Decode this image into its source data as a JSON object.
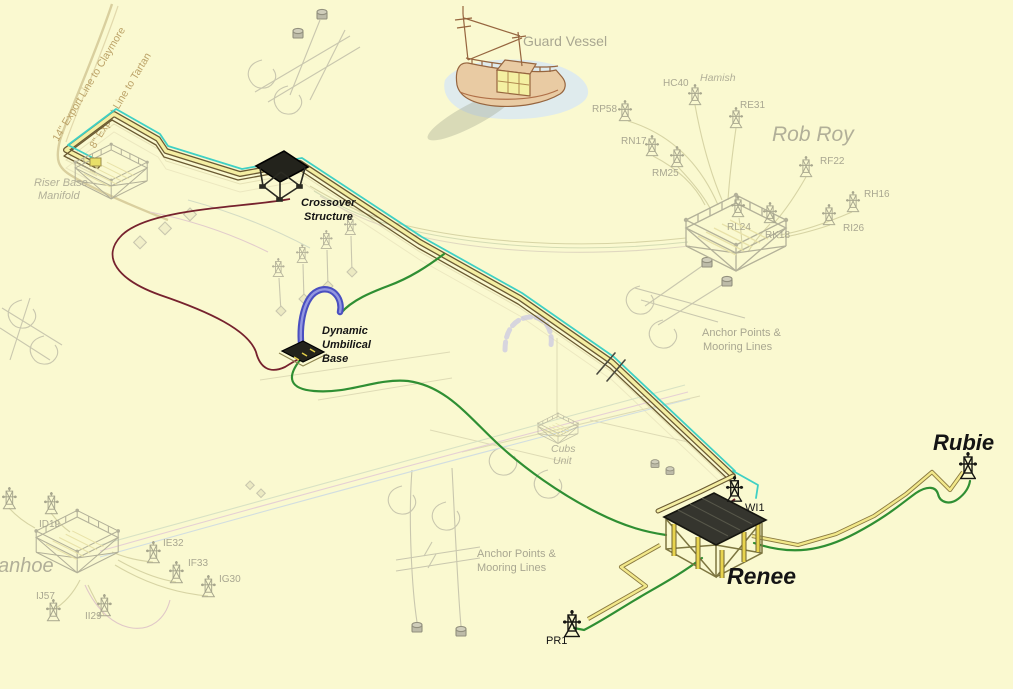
{
  "labels": {
    "guard_vessel": "Guard Vessel",
    "rob_roy": "Rob Roy",
    "hamish": "Hamish",
    "ivanhoe_partial": "anhoe",
    "renee": "Renee",
    "rubie": "Rubie",
    "riser_base_manifold": [
      "Riser Base",
      "Manifold"
    ],
    "crossover_structure": [
      "Crossover",
      "Structure"
    ],
    "dynamic_umbilical_base": [
      "Dynamic",
      "Umbilical",
      "Base"
    ],
    "cubs_unit": [
      "Cubs",
      "Unit"
    ],
    "anchor_points": [
      "Anchor Points &",
      "Mooring Lines"
    ],
    "export_line_claymore": "14\" Export Line to Claymore",
    "export_line_tartan": "8\" Export Line to Tartan"
  },
  "wells": {
    "rob_roy": {
      "rp58": "RP58",
      "hc40": "HC40",
      "re31": "RE31",
      "rn17": "RN17",
      "rm25": "RM25",
      "rf22": "RF22",
      "rh16": "RH16",
      "ri26": "RI26",
      "rl24": "RL24",
      "rk18": "RK18"
    },
    "ivanhoe": {
      "id19": "ID19",
      "ie32": "IE32",
      "if33": "IF33",
      "ig30": "IG30",
      "ij57": "IJ57",
      "ii29": "II29"
    },
    "renee_area": {
      "wi1": "WI1",
      "pr1": "PR1"
    }
  },
  "colors": {
    "background": "#faf9d0",
    "pipeline_cyan": "#3fd0c4",
    "pipeline_yellow": "#f4eea2",
    "pipeline_dark": "#6a5a32",
    "umbilical_maroon": "#76222e",
    "flowline_green": "#2f8f33",
    "flowline_yellow": "#efe176",
    "dynamic_umbilical_blue": "#4a4fc0",
    "ghost_gray": "#b3b199",
    "label_gray": "#a9a791",
    "label_black": "#141414",
    "export_tan": "#bca368"
  }
}
